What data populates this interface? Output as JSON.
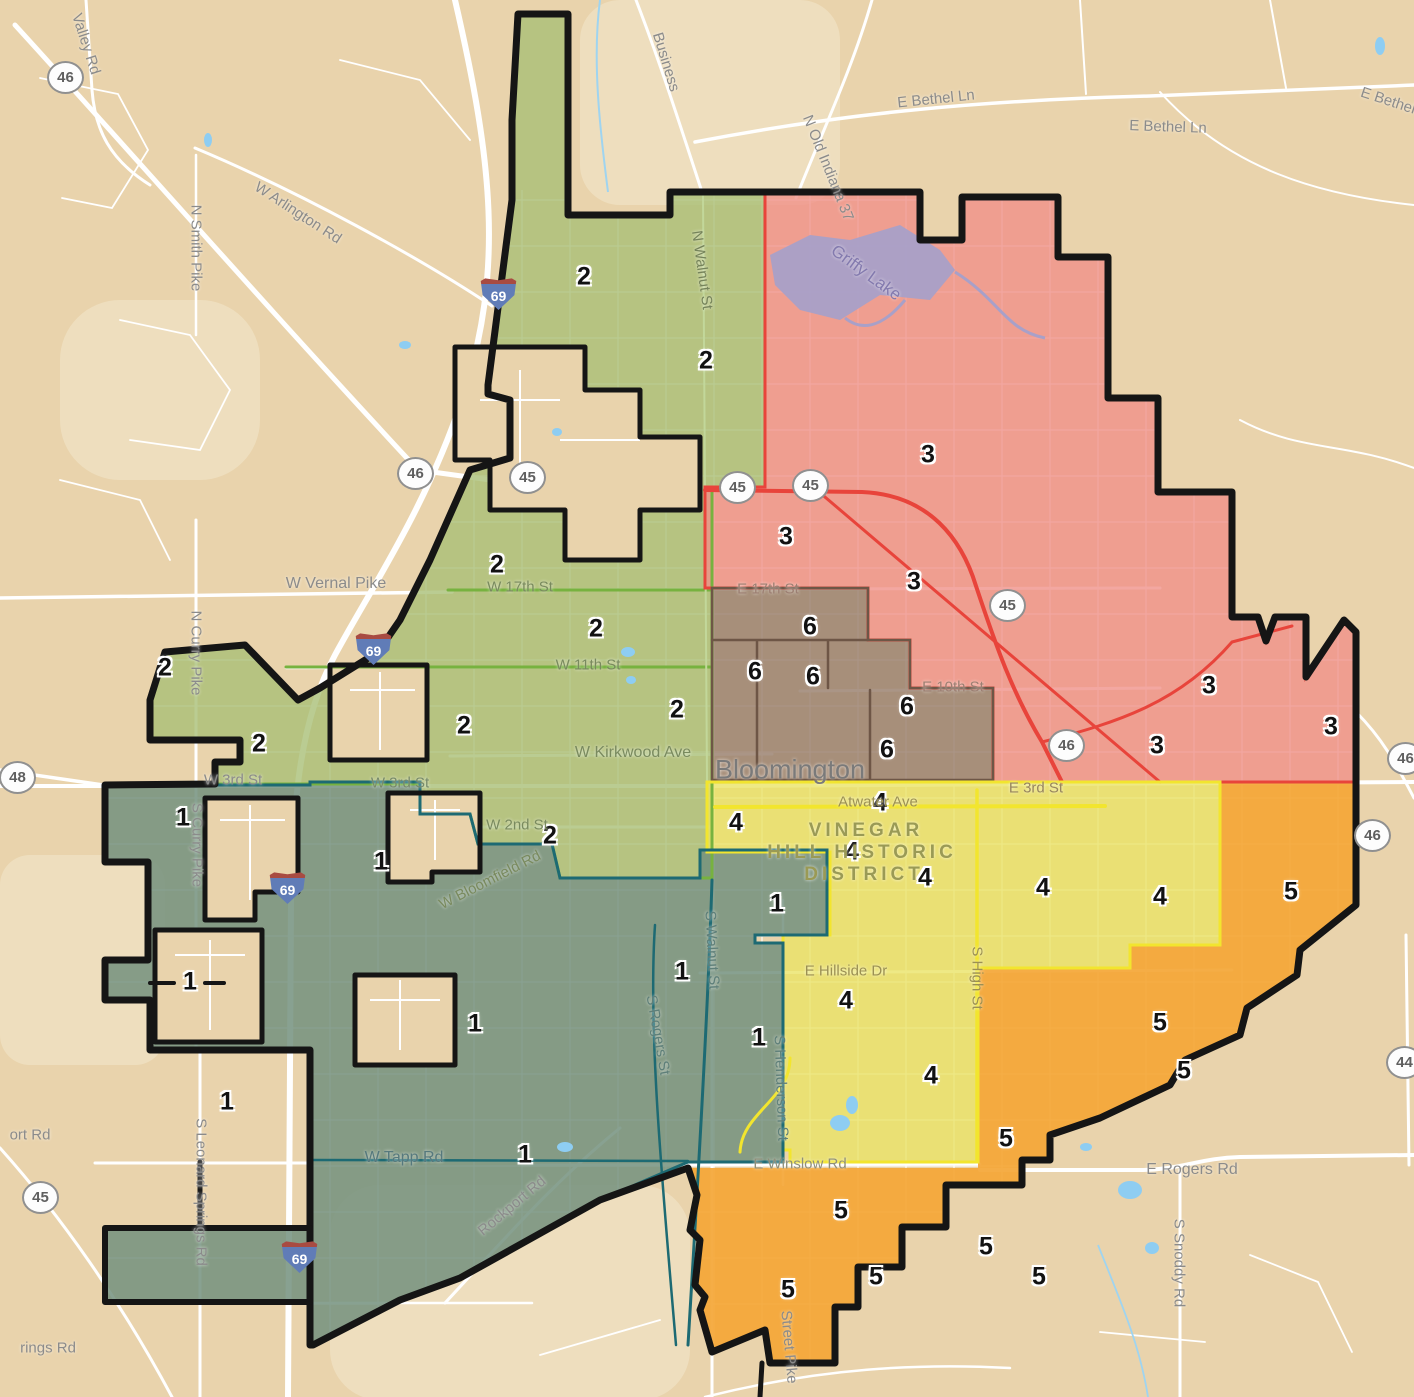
{
  "map": {
    "background": "#e9d3ac",
    "road_color": "#ffffff",
    "boundary_color": "#151515",
    "water_color": "#8ecdf2",
    "lake_color": "#a8a0c8"
  },
  "districts": [
    {
      "id": "1",
      "color": "#73907e",
      "border": "#1d6a73",
      "labels": [
        [
          183,
          818
        ],
        [
          381,
          862
        ],
        [
          777,
          904
        ],
        [
          682,
          972
        ],
        [
          475,
          1024
        ],
        [
          759,
          1038
        ],
        [
          190,
          982
        ],
        [
          227,
          1102
        ],
        [
          525,
          1155
        ]
      ]
    },
    {
      "id": "2",
      "color": "#a9bf77",
      "border": "#77b23f",
      "labels": [
        [
          584,
          277
        ],
        [
          706,
          361
        ],
        [
          497,
          565
        ],
        [
          596,
          629
        ],
        [
          677,
          710
        ],
        [
          464,
          726
        ],
        [
          165,
          668
        ],
        [
          259,
          744
        ],
        [
          550,
          836
        ]
      ]
    },
    {
      "id": "3",
      "color": "#f0918a",
      "border": "#e8443b",
      "labels": [
        [
          928,
          455
        ],
        [
          786,
          537
        ],
        [
          914,
          582
        ],
        [
          1209,
          686
        ],
        [
          1331,
          727
        ],
        [
          1157,
          746
        ]
      ]
    },
    {
      "id": "4",
      "color": "#eae366",
      "border": "#f2e52e",
      "labels": [
        [
          736,
          823
        ],
        [
          880,
          803
        ],
        [
          852,
          852
        ],
        [
          925,
          878
        ],
        [
          1043,
          888
        ],
        [
          1160,
          897
        ],
        [
          846,
          1001
        ],
        [
          931,
          1076
        ]
      ]
    },
    {
      "id": "5",
      "color": "#f4a636",
      "border": "#ef9d2a",
      "labels": [
        [
          1291,
          892
        ],
        [
          1160,
          1023
        ],
        [
          1184,
          1071
        ],
        [
          1006,
          1139
        ],
        [
          841,
          1211
        ],
        [
          986,
          1247
        ],
        [
          876,
          1277
        ],
        [
          1039,
          1277
        ],
        [
          788,
          1290
        ]
      ]
    },
    {
      "id": "6",
      "color": "#9b8271",
      "border": "#6e5646",
      "labels": [
        [
          810,
          627
        ],
        [
          755,
          672
        ],
        [
          813,
          677
        ],
        [
          907,
          707
        ],
        [
          887,
          750
        ]
      ]
    }
  ],
  "road_labels": [
    {
      "name": "valley-rd",
      "text": "Valley Rd",
      "x": 86,
      "y": 44,
      "r": 72
    },
    {
      "name": "w-arlington-rd",
      "text": "W Arlington Rd",
      "x": 298,
      "y": 213,
      "r": 33
    },
    {
      "name": "n-smith-pike",
      "text": "N Smith Pike",
      "x": 196,
      "y": 248,
      "r": 90
    },
    {
      "name": "business-37",
      "text": "Business",
      "x": 666,
      "y": 62,
      "r": 73
    },
    {
      "name": "n-old-indiana-37",
      "text": "N Old Indiana 37",
      "x": 828,
      "y": 168,
      "r": 68
    },
    {
      "name": "e-bethel-ln-1",
      "text": "E Bethel Ln",
      "x": 936,
      "y": 99,
      "r": -6
    },
    {
      "name": "e-bethel-ln-2",
      "text": "E Bethel Ln",
      "x": 1168,
      "y": 127,
      "r": 2
    },
    {
      "name": "e-bethel-ln-3",
      "text": "E Bethel Ln",
      "x": 1398,
      "y": 104,
      "r": 18
    },
    {
      "name": "griffy-lake",
      "text": "Griffy Lake",
      "x": 866,
      "y": 273,
      "r": 36,
      "s": 17,
      "c": "#837aae"
    },
    {
      "name": "n-walnut-st",
      "text": "N Walnut St",
      "x": 702,
      "y": 270,
      "r": 82,
      "c": "#75835a"
    },
    {
      "name": "w-vernal-pike",
      "text": "W Vernal Pike",
      "x": 336,
      "y": 584,
      "s": 16
    },
    {
      "name": "n-curry-pike",
      "text": "N Curry Pike",
      "x": 196,
      "y": 653,
      "r": 90
    },
    {
      "name": "w-17th-st",
      "text": "W 17th St",
      "x": 520,
      "y": 587,
      "c": "#798a5e"
    },
    {
      "name": "e-17th-st",
      "text": "E 17th St",
      "x": 768,
      "y": 589,
      "c": "#9c7f72"
    },
    {
      "name": "w-11th-st",
      "text": "W 11th St",
      "x": 588,
      "y": 665,
      "c": "#798a5e"
    },
    {
      "name": "e-10th-st",
      "text": "E 10th St",
      "x": 953,
      "y": 687,
      "c": "#9c7f72"
    },
    {
      "name": "w-kirkwood-ave",
      "text": "W Kirkwood Ave",
      "x": 633,
      "y": 753,
      "s": 16,
      "c": "#798a5e"
    },
    {
      "name": "e-3rd-st",
      "text": "E 3rd St",
      "x": 1036,
      "y": 788,
      "c": "#97855e"
    },
    {
      "name": "w-3rd-st-1",
      "text": "W 3rd St",
      "x": 233,
      "y": 780
    },
    {
      "name": "w-3rd-st-2",
      "text": "W 3rd St",
      "x": 400,
      "y": 783,
      "c": "#778a6a"
    },
    {
      "name": "w-2nd-st",
      "text": "W 2nd St",
      "x": 517,
      "y": 825,
      "c": "#798a5e"
    },
    {
      "name": "atwater-ave",
      "text": "Atwater Ave",
      "x": 878,
      "y": 802,
      "c": "#9b9053"
    },
    {
      "name": "s-curry-pike",
      "text": "S Curry Pike",
      "x": 197,
      "y": 845,
      "r": 90
    },
    {
      "name": "w-bloomfield-rd",
      "text": "W Bloomfield Rd",
      "x": 490,
      "y": 880,
      "r": -27,
      "c": "#798a5e"
    },
    {
      "name": "s-walnut-st",
      "text": "S Walnut St",
      "x": 712,
      "y": 950,
      "r": 87,
      "c": "#5e7f79"
    },
    {
      "name": "s-rogers-st",
      "text": "S Rogers St",
      "x": 658,
      "y": 1035,
      "r": 80,
      "c": "#5e7f79"
    },
    {
      "name": "s-henderson-st",
      "text": "S Henderson St",
      "x": 781,
      "y": 1088,
      "r": 88,
      "c": "#5e7f79"
    },
    {
      "name": "s-high-st",
      "text": "S High St",
      "x": 977,
      "y": 978,
      "r": 90,
      "c": "#9b9053"
    },
    {
      "name": "e-hillside-dr",
      "text": "E Hillside Dr",
      "x": 846,
      "y": 971,
      "c": "#9b9053"
    },
    {
      "name": "e-winslow-rd",
      "text": "E Winslow Rd",
      "x": 800,
      "y": 1164,
      "c": "#8f8f7a"
    },
    {
      "name": "w-tapp-rd",
      "text": "W Tapp Rd",
      "x": 404,
      "y": 1158,
      "s": 16,
      "c": "#56797d"
    },
    {
      "name": "rockport-rd",
      "text": "Rockport Rd",
      "x": 512,
      "y": 1206,
      "r": -40
    },
    {
      "name": "s-leonard-springs-rd",
      "text": "S Leonard Springs Rd",
      "x": 201,
      "y": 1192,
      "r": 90
    },
    {
      "name": "e-rogers-rd",
      "text": "E Rogers Rd",
      "x": 1192,
      "y": 1170,
      "s": 16
    },
    {
      "name": "s-snoddy-rd",
      "text": "S Snoddy Rd",
      "x": 1179,
      "y": 1263,
      "r": 90
    },
    {
      "name": "s-walnut-street-pike",
      "text": "Street Pike",
      "x": 789,
      "y": 1347,
      "r": 85
    },
    {
      "name": "airport-rd-fragment",
      "text": "ort Rd",
      "x": 30,
      "y": 1135
    },
    {
      "name": "springs-rd-fragment",
      "text": "rings Rd",
      "x": 48,
      "y": 1348
    },
    {
      "name": "city-bloomington",
      "text": "Bloomington",
      "x": 790,
      "y": 770,
      "s": 27,
      "c": "#7a7a7a"
    },
    {
      "name": "vinegar-hill-line1",
      "text": "VINEGAR",
      "x": 866,
      "y": 831,
      "s": 19,
      "c": "#9a9a55",
      "ls": 4,
      "b": 1
    },
    {
      "name": "vinegar-hill-line2",
      "text": "HILL HISTORIC",
      "x": 862,
      "y": 853,
      "s": 19,
      "c": "#9a9a55",
      "ls": 4,
      "b": 1
    },
    {
      "name": "vinegar-hill-line3",
      "text": "DISTRICT",
      "x": 864,
      "y": 875,
      "s": 19,
      "c": "#9a9a55",
      "ls": 4,
      "b": 1
    }
  ],
  "shields": [
    {
      "kind": "state",
      "num": "46",
      "x": 65,
      "y": 77
    },
    {
      "kind": "i",
      "num": "69",
      "x": 498,
      "y": 293
    },
    {
      "kind": "state",
      "num": "46",
      "x": 415,
      "y": 473
    },
    {
      "kind": "state",
      "num": "45",
      "x": 527,
      "y": 477
    },
    {
      "kind": "state",
      "num": "45",
      "x": 737,
      "y": 487
    },
    {
      "kind": "state",
      "num": "45",
      "x": 810,
      "y": 485
    },
    {
      "kind": "state",
      "num": "45",
      "x": 1007,
      "y": 605
    },
    {
      "kind": "state",
      "num": "46",
      "x": 1066,
      "y": 745
    },
    {
      "kind": "state",
      "num": "46",
      "x": 1405,
      "y": 758
    },
    {
      "kind": "state",
      "num": "46",
      "x": 1372,
      "y": 835
    },
    {
      "kind": "state",
      "num": "48",
      "x": 17,
      "y": 777
    },
    {
      "kind": "i",
      "num": "69",
      "x": 373,
      "y": 648
    },
    {
      "kind": "i",
      "num": "69",
      "x": 287,
      "y": 887
    },
    {
      "kind": "i",
      "num": "69",
      "x": 299,
      "y": 1256
    },
    {
      "kind": "state",
      "num": "45",
      "x": 40,
      "y": 1197
    },
    {
      "kind": "state",
      "num": "44",
      "x": 1404,
      "y": 1062
    }
  ]
}
